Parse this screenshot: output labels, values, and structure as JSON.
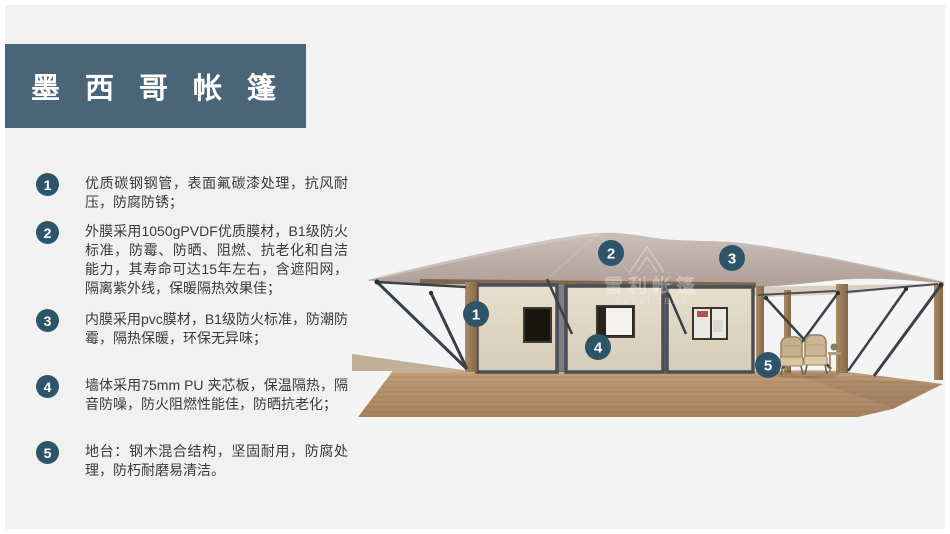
{
  "header": {
    "title": "墨西哥帐篷"
  },
  "features": [
    {
      "num": "1",
      "text": "优质碳钢钢管，表面氟碳漆处理，抗风耐压，防腐防锈；"
    },
    {
      "num": "2",
      "text": "外膜采用1050gPVDF优质膜材，B1级防火标准，防霉、防晒、阻燃、抗老化和自洁能力，其寿命可达15年左右，含遮阳网，隔离紫外线，保暖隔热效果佳；"
    },
    {
      "num": "3",
      "text": "内膜采用pvc膜材，B1级防火标准，防潮防霉，隔热保暖，环保无异味；"
    },
    {
      "num": "4",
      "text": "墙体采用75mm PU 夹芯板，保温隔热，隔音防噪，防火阻燃性能佳，防晒抗老化；"
    },
    {
      "num": "5",
      "text": "地台：钢木混合结构，坚固耐用，防腐处理，防朽耐磨易清洁。"
    }
  ],
  "illustration": {
    "watermark": {
      "cn": "雪利帐篷",
      "en": "XUELI TENT"
    },
    "markers": [
      {
        "num": "1"
      },
      {
        "num": "2"
      },
      {
        "num": "3"
      },
      {
        "num": "4"
      },
      {
        "num": "5"
      }
    ]
  },
  "colors": {
    "accent_badge": "#2d5468",
    "title_bg": "#4a6478",
    "page_bg": "#f1f1f2",
    "roof": "#bcaea6",
    "wall": "#ded6c4",
    "deck_wood": "#b3916e",
    "steel": "#3a4148",
    "body_text": "#3a3a3a"
  }
}
